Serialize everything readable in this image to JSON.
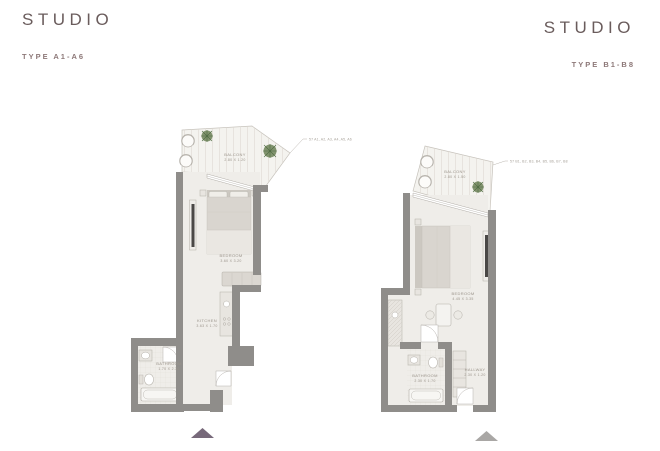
{
  "colors": {
    "title": "#6a5c5c",
    "subtitle": "#8d7878",
    "wall": "#8f8d8a",
    "floor": "#efede9",
    "balcony-floor": "#f4f3ef",
    "plank": "#ddd8d1",
    "line": "#b3afa8",
    "furn": "#e8e5e0",
    "bed": "#d9d5cf",
    "bed-light": "#eae7e2",
    "plant": "#74885f",
    "plant-dark": "#4e6b42",
    "label": "#9b948b",
    "callout": "#a8a29a",
    "tri-left": "#77697a",
    "tri-right": "#a9a7a5",
    "tv": "#4a4846"
  },
  "plans": [
    {
      "title": "STUDIO",
      "type_label": "TYPE A1-A6",
      "unit_callout": "57 A1, A2, A3, A4, A5, A6",
      "rooms": {
        "balcony": {
          "name": "BALCONY",
          "dims": "2.80 X 1.20"
        },
        "bedroom": {
          "name": "BEDROOM",
          "dims": "3.60 X 3.20"
        },
        "kitchen": {
          "name": "KITCHEN",
          "dims": "3.63 X 1.70"
        },
        "bathroom": {
          "name": "BATHROOM",
          "dims": "1.70 X 2.30"
        }
      }
    },
    {
      "title": "STUDIO",
      "type_label": "TYPE B1-B8",
      "unit_callout": "57 B1, B2, B3, B4, B5, B6, B7, B8",
      "rooms": {
        "balcony": {
          "name": "BALCONY",
          "dims": "2.80 X 1.50"
        },
        "bedroom": {
          "name": "BEDROOM",
          "dims": "4.45 X 3.35"
        },
        "bathroom": {
          "name": "BATHROOM",
          "dims": "2.30 X 1.70"
        },
        "hallway": {
          "name": "HALLWAY",
          "dims": "2.30 X 1.20"
        }
      }
    }
  ]
}
